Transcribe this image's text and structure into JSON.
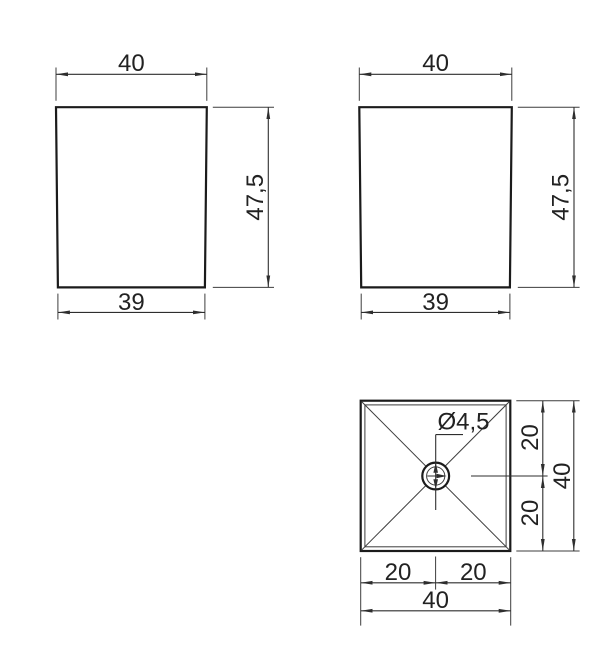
{
  "drawing": {
    "title": "square-leg-technical-drawing",
    "front_view": {
      "top_width": "40",
      "side_height": "47,5",
      "bottom_width": "39"
    },
    "side_view": {
      "top_width": "40",
      "side_height": "47,5",
      "bottom_width": "39"
    },
    "bottom_view": {
      "hole_diameter": "Ø4,5",
      "right_upper": "20",
      "right_lower": "20",
      "right_total": "40",
      "bottom_left": "20",
      "bottom_right": "20",
      "bottom_total": "40"
    },
    "colors": {
      "outline": "#1b1b1b",
      "dimension_line": "#2e2e2e",
      "text": "#222222",
      "background": "#ffffff"
    }
  }
}
